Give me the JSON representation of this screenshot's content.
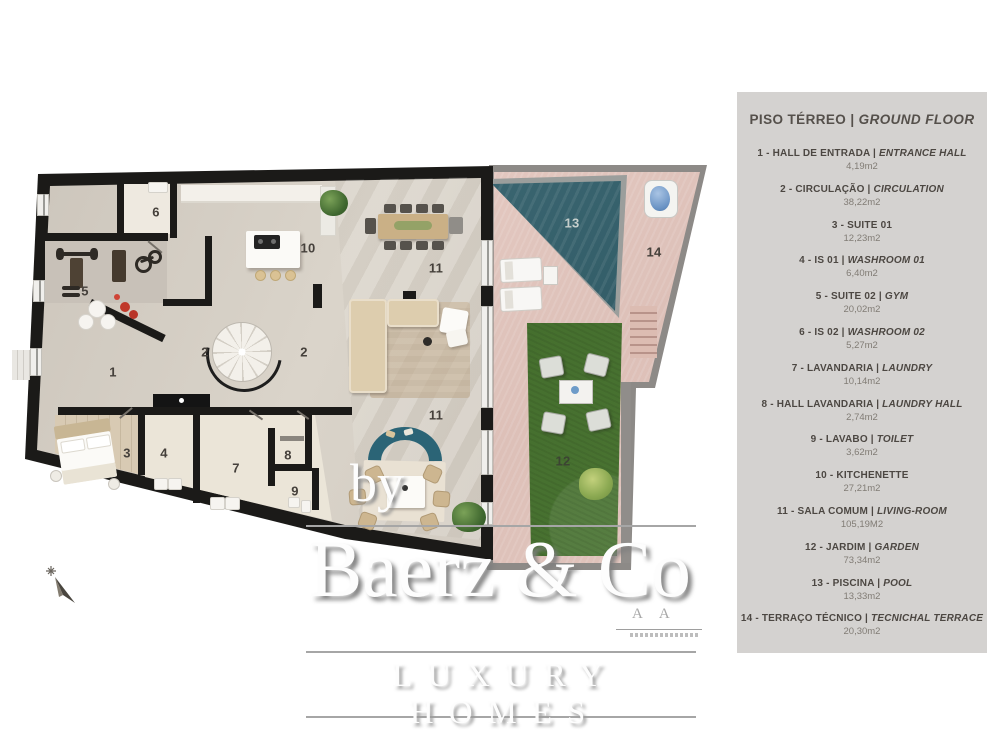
{
  "legend": {
    "title_pt": "PISO TÉRREO | ",
    "title_en": "GROUND FLOOR",
    "items": [
      {
        "pt": "1 - HALL DE ENTRADA | ",
        "en": "ENTRANCE HALL",
        "area": "4,19m2"
      },
      {
        "pt": "2 - CIRCULAÇÃO | ",
        "en": "CIRCULATION",
        "area": "38,22m2"
      },
      {
        "pt": "3 - SUITE 01",
        "en": "",
        "area": "12,23m2"
      },
      {
        "pt": "4 - IS 01 | ",
        "en": "WASHROOM 01",
        "area": "6,40m2"
      },
      {
        "pt": "5 - SUITE 02 | ",
        "en": "GYM",
        "area": "20,02m2"
      },
      {
        "pt": "6 - IS 02 | ",
        "en": "WASHROOM 02",
        "area": "5,27m2"
      },
      {
        "pt": "7 - LAVANDARIA | ",
        "en": "LAUNDRY",
        "area": "10,14m2"
      },
      {
        "pt": "8 - HALL LAVANDARIA | ",
        "en": "LAUNDRY HALL",
        "area": "2,74m2"
      },
      {
        "pt": "9 - LAVABO | ",
        "en": "TOILET",
        "area": "3,62m2"
      },
      {
        "pt": "10 - KITCHENETTE",
        "en": "",
        "area": "27,21m2"
      },
      {
        "pt": "11 - SALA COMUM | ",
        "en": "LIVING-ROOM",
        "area": "105,19M2"
      },
      {
        "pt": "12 - JARDIM | ",
        "en": "GARDEN",
        "area": "73,34m2"
      },
      {
        "pt": "13 - PISCINA | ",
        "en": "POOL",
        "area": "13,33m2"
      },
      {
        "pt": "14 - TERRAÇO TÉCNICO | ",
        "en": "TECNICHAL TERRACE",
        "area": "20,30m2"
      }
    ]
  },
  "floorplan": {
    "room_labels": {
      "r1": "1",
      "r2a": "2",
      "r2b": "2",
      "r3": "3",
      "r4": "4",
      "r5": "5",
      "r6": "6",
      "r7": "7",
      "r8": "8",
      "r9": "9",
      "r10": "10",
      "r11a": "11",
      "r11b": "11",
      "r12": "12",
      "r13": "13",
      "r14": "14"
    },
    "colors": {
      "wall": "#1b1a18",
      "floor": "#d2cbc2",
      "pool": "#35606b",
      "grass": "#4d7837",
      "paving": "#e5c9c1",
      "accent_sofa": "#2b6476",
      "legend_bg": "#d4d2d0"
    }
  },
  "watermark": {
    "by": "by",
    "brand": "Baerz & Co",
    "brand_sub": "A A",
    "tagline": "LUXURY HOMES"
  }
}
